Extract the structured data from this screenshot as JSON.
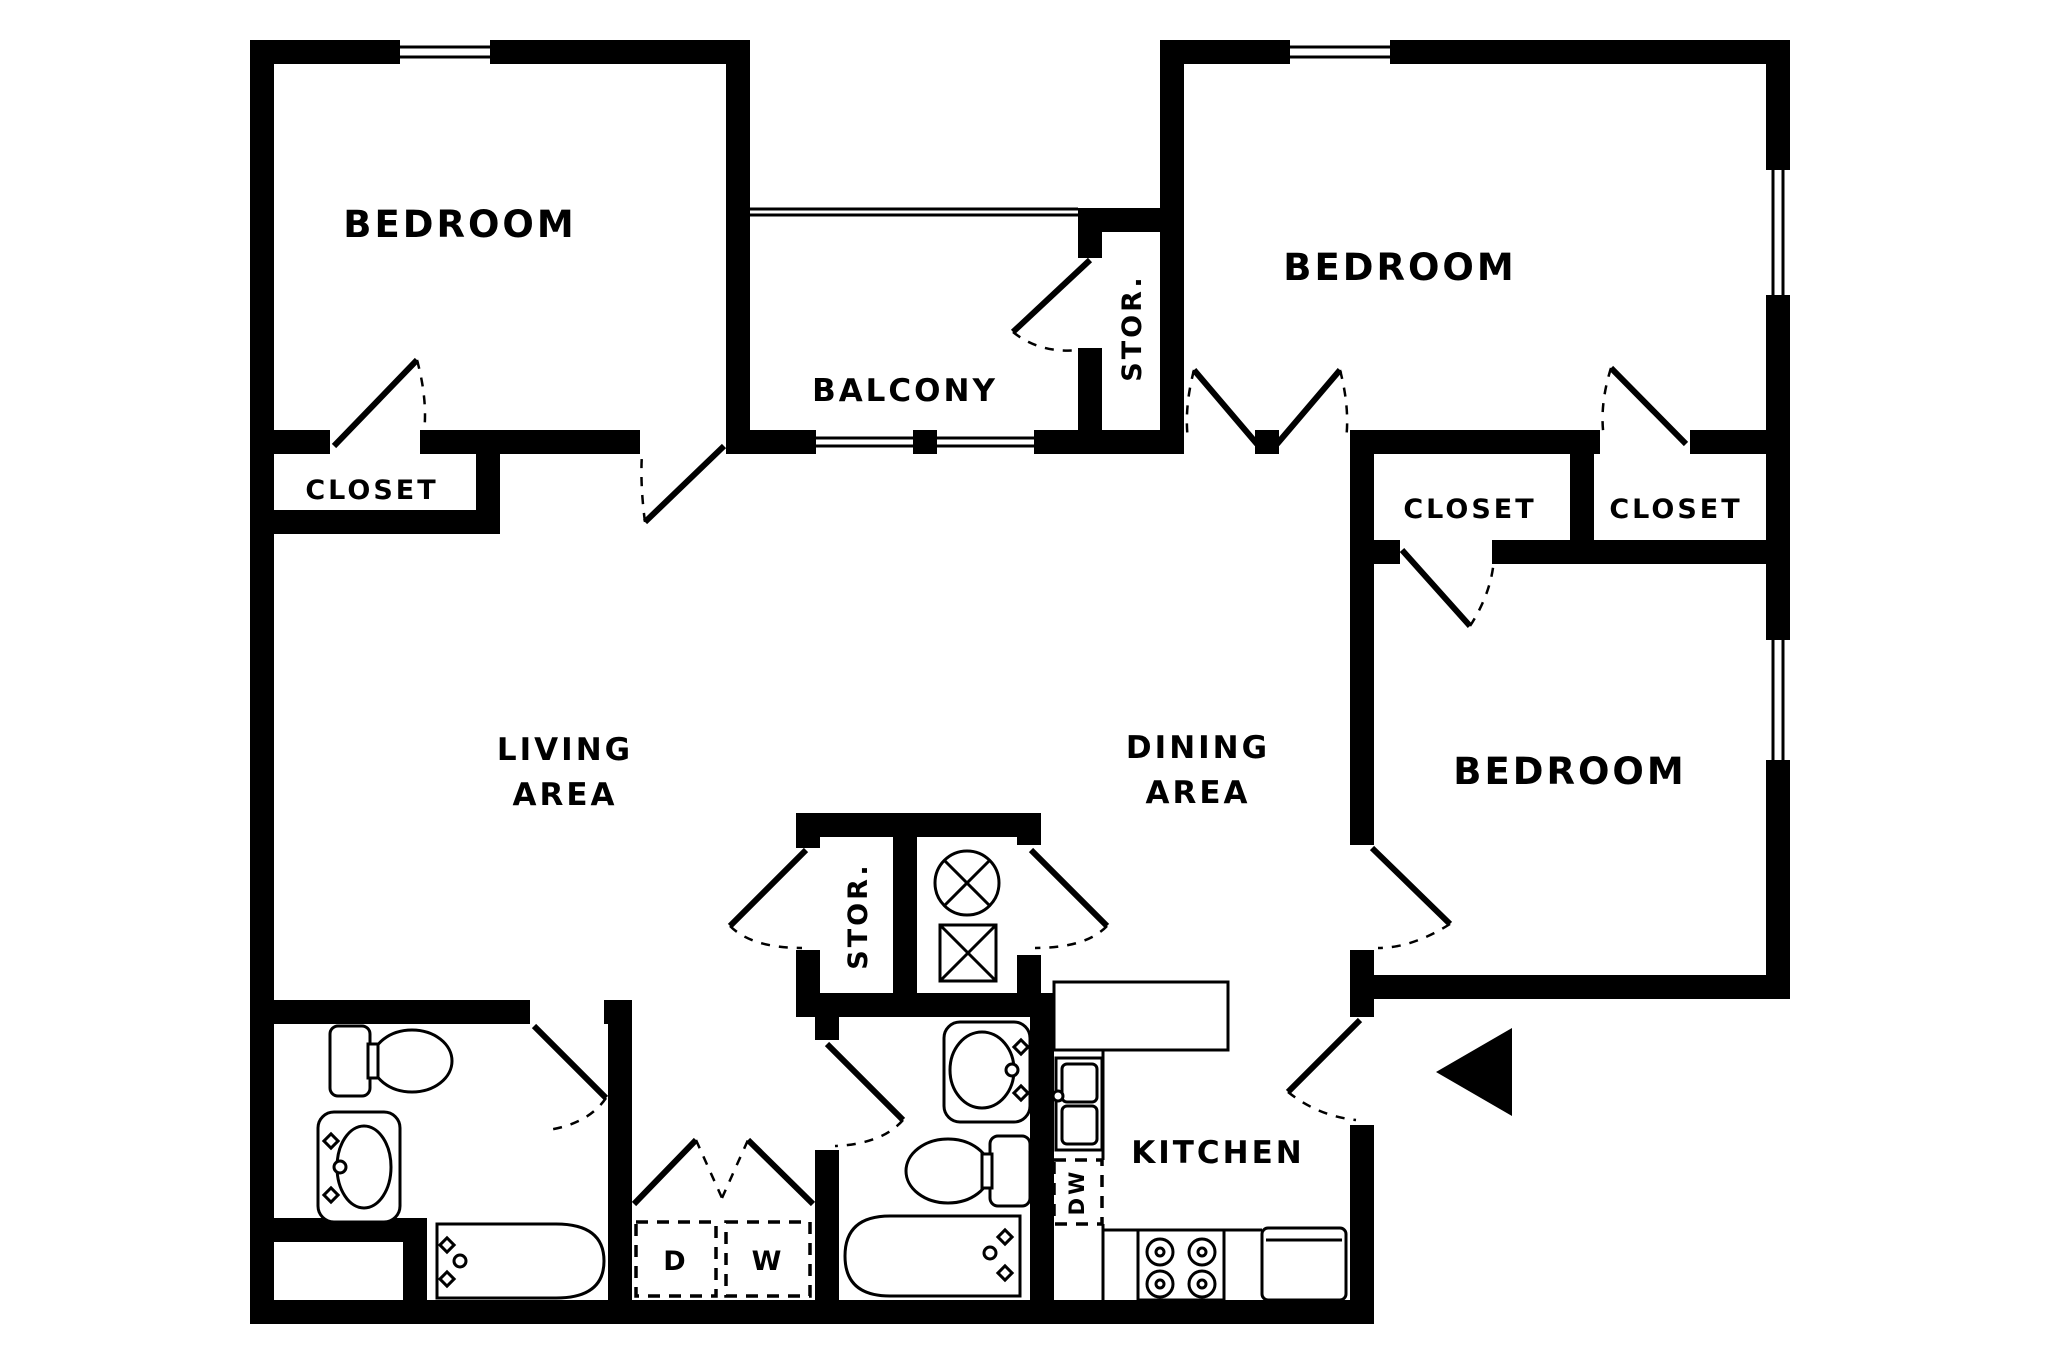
{
  "colors": {
    "wall": "#000000",
    "background": "#ffffff"
  },
  "labels": {
    "bedroom_top_left": "BEDROOM",
    "closet_top_left": "CLOSET",
    "balcony": "BALCONY",
    "storage_upper": "STOR.",
    "bedroom_top_right": "BEDROOM",
    "closet_right_1": "CLOSET",
    "closet_right_2": "CLOSET",
    "bedroom_middle_right": "BEDROOM",
    "living_line1": "LIVING",
    "living_line2": "AREA",
    "dining_line1": "DINING",
    "dining_line2": "AREA",
    "storage_central": "STOR.",
    "kitchen": "KITCHEN",
    "dryer": "D",
    "washer": "W",
    "dishwasher": "DW"
  }
}
